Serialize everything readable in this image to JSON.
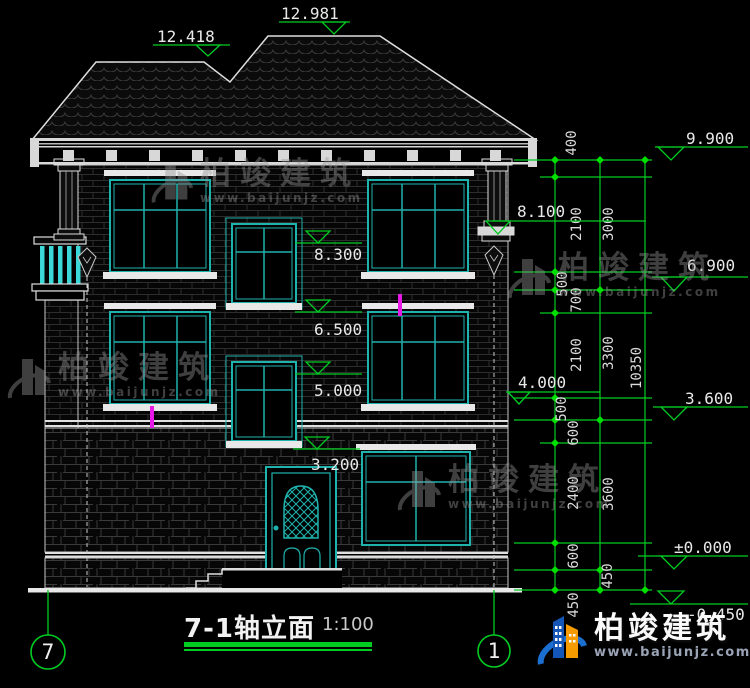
{
  "drawing": {
    "title": "7-1轴立面",
    "scale": "1:100",
    "axis_left": "7",
    "axis_right": "1"
  },
  "levels": {
    "roof_low": "12.418",
    "roof_high": "12.981",
    "r9900": "9.900",
    "r8100": "8.100",
    "r6900": "6.900",
    "r4000": "4.000",
    "r3600": "3.600",
    "rzero": "±0.000",
    "rneg450": "-0.450",
    "i8300": "8.300",
    "i6500": "6.500",
    "i5000": "5.000",
    "i3200": "3.200"
  },
  "dims": {
    "chain1": [
      "400",
      "2100",
      "500",
      "700",
      "2100",
      "500",
      "600",
      "2400",
      "600",
      "450"
    ],
    "chain2": [
      "3000",
      "3300",
      "3600",
      "450"
    ],
    "chain3": [
      "10350"
    ]
  },
  "watermark": {
    "brand": "柏竣建筑",
    "url": "www.baijunjz.com"
  },
  "logo": {
    "brand": "柏竣建筑",
    "url": "www.baijunjz.com"
  },
  "colors": {
    "line": "#e6e6e6",
    "window": "#1fb3ae",
    "baluster": "#3cd8d8",
    "dimension": "#00cc22",
    "tick": "#00e000",
    "magenta": "#e619e6",
    "logo_blue": "#1a6fd0",
    "logo_orange": "#f59b00"
  }
}
